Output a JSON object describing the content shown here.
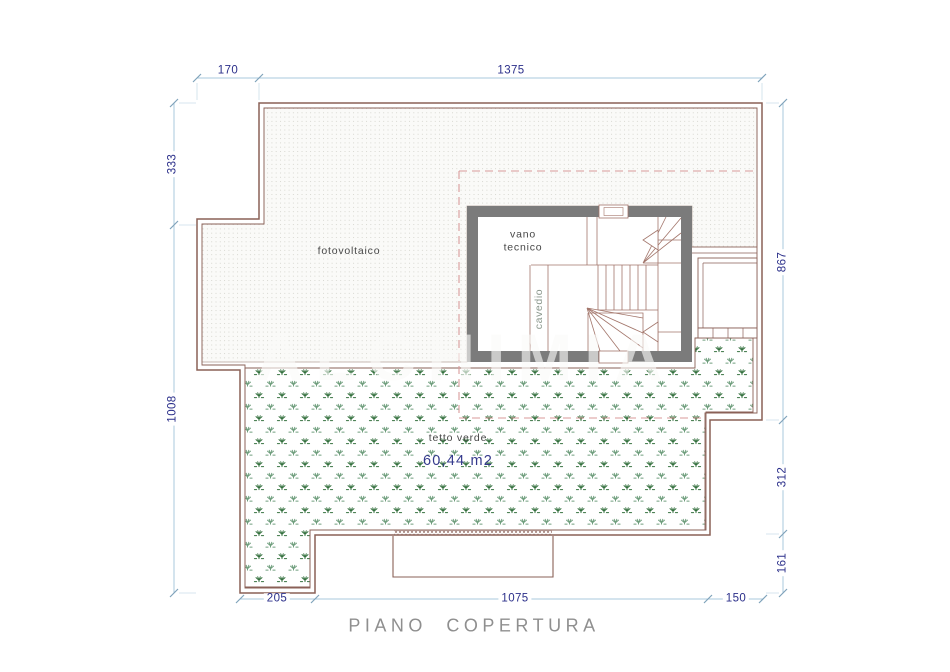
{
  "drawing": {
    "title": "PIANO COPERTURA",
    "watermark": "ALCHIMIA",
    "areas": {
      "fotovoltaico": "fotovoltaico",
      "vano_tecnico": "vano tecnico",
      "cavedio": "cavedio",
      "tetto_verde": "tetto verde",
      "tetto_verde_area": "60,44 m2"
    },
    "dimensions": {
      "top": [
        "170",
        "1375"
      ],
      "left": [
        "333",
        "1008"
      ],
      "right": [
        "867",
        "312",
        "161"
      ],
      "bottom": [
        "205",
        "1075",
        "150"
      ]
    },
    "colors": {
      "outline_brown": "#8a6057",
      "wall_gray": "#7b7b7b",
      "dimension_text_navy": "#2b2f8a",
      "dimension_line_blue": "#aac8dc",
      "green_roof_symbol": "#35713f",
      "dashed_overlay_pink": "#d89a9a",
      "title_gray": "#8f8f8f"
    }
  }
}
